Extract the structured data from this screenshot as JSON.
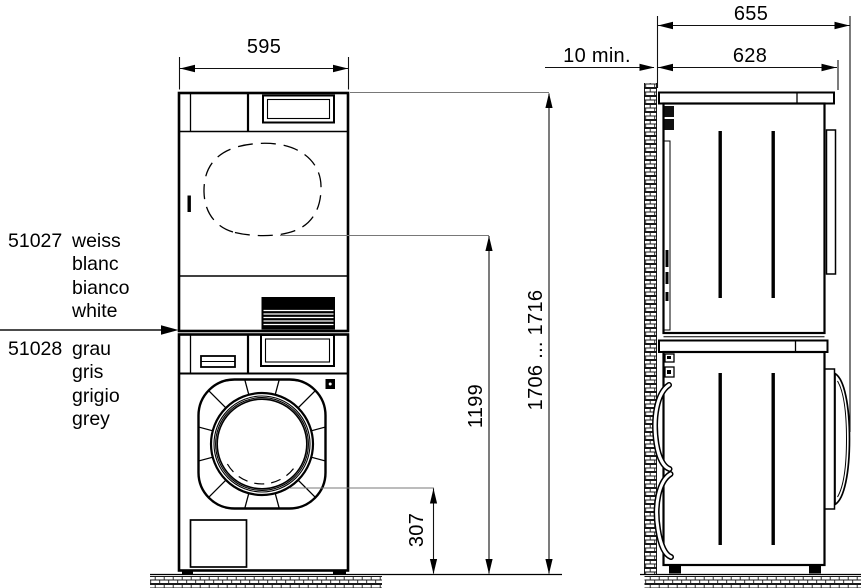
{
  "product_labels": {
    "white_variant": {
      "code": "51027",
      "names": [
        "weiss",
        "blanc",
        "bianco",
        "white"
      ]
    },
    "grey_variant": {
      "code": "51028",
      "names": [
        "grau",
        "gris",
        "grigio",
        "grey"
      ]
    }
  },
  "dimensions": {
    "front_width": "595",
    "total_height_range": "1706 ... 1716",
    "dryer_door_center_height": "1199",
    "washer_door_bottom_height": "307",
    "depth_with_door": "655",
    "body_depth": "628",
    "wall_clearance_min": "10 min."
  },
  "colors": {
    "line": "#000000",
    "leader": "#787878",
    "background": "#ffffff"
  }
}
